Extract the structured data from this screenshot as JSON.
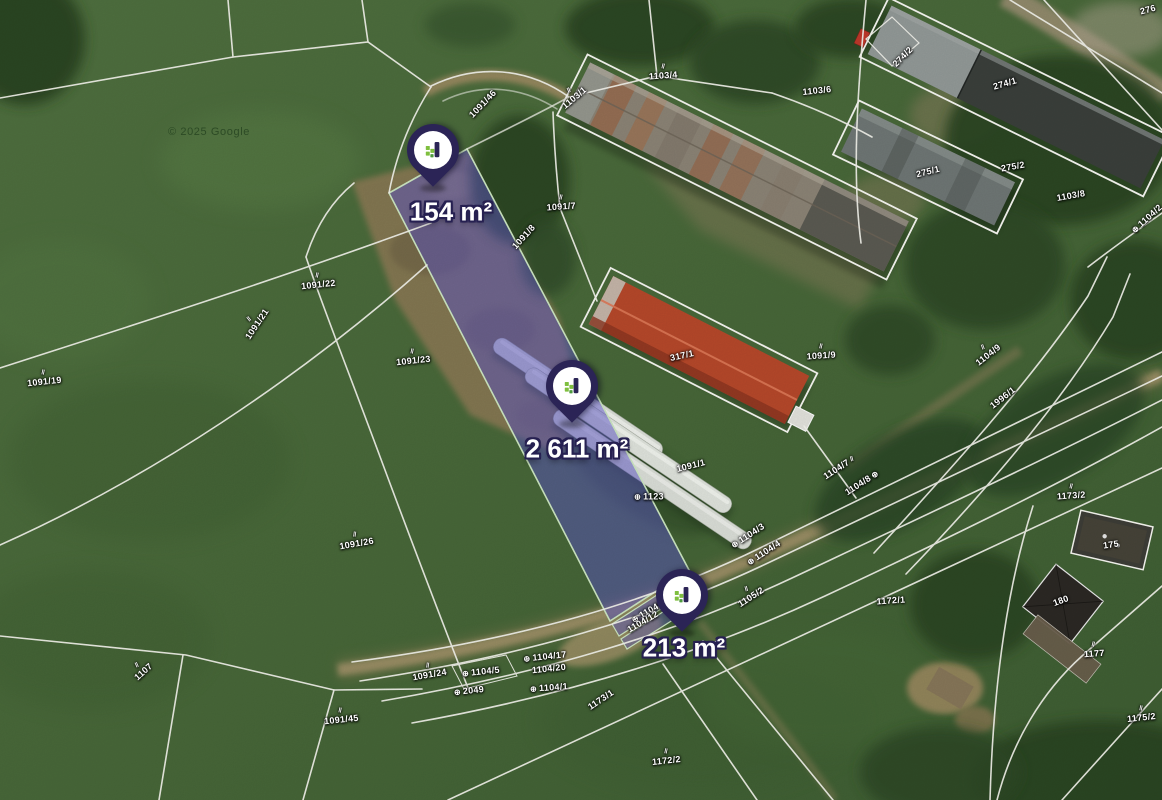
{
  "map": {
    "attribution": "© 2025 Google",
    "colors": {
      "pin": "#2b2456",
      "pin_logo_green": "#7fbf3f",
      "highlight_fill": "#5b54c9",
      "highlight_border": "#cfe9c4",
      "cadastral_line": "#f7f7f0"
    },
    "pin_markers": [
      {
        "area": "154 m²",
        "x": 433,
        "y": 150,
        "label_x": 451,
        "label_y": 212
      },
      {
        "area": "2 611 m²",
        "x": 572,
        "y": 386,
        "label_x": 577,
        "label_y": 449
      },
      {
        "area": "213 m²",
        "x": 682,
        "y": 595,
        "label_x": 684,
        "label_y": 648
      }
    ],
    "parcel_labels": [
      {
        "text": "1103/4",
        "x": 663,
        "y": 72,
        "rot": -4,
        "mark": "hatch"
      },
      {
        "text": "1103/1",
        "x": 572,
        "y": 95,
        "rot": -40,
        "mark": "hatch"
      },
      {
        "text": "1103/6",
        "x": 817,
        "y": 91,
        "rot": -6,
        "mark": null
      },
      {
        "text": "274/2",
        "x": 903,
        "y": 57,
        "rot": -45,
        "mark": null
      },
      {
        "text": "274/1",
        "x": 1005,
        "y": 84,
        "rot": -16,
        "mark": null
      },
      {
        "text": "275/1",
        "x": 928,
        "y": 172,
        "rot": -14,
        "mark": null
      },
      {
        "text": "275/2",
        "x": 1013,
        "y": 167,
        "rot": -10,
        "mark": null
      },
      {
        "text": "1103/8",
        "x": 1071,
        "y": 196,
        "rot": -10,
        "mark": null
      },
      {
        "text": "276",
        "x": 1148,
        "y": 10,
        "rot": -15,
        "mark": null
      },
      {
        "text": "1104/2",
        "x": 1147,
        "y": 219,
        "rot": -42,
        "mark": "circle"
      },
      {
        "text": "1091/46",
        "x": 483,
        "y": 104,
        "rot": -46,
        "mark": null
      },
      {
        "text": "1091/7",
        "x": 561,
        "y": 203,
        "rot": -4,
        "mark": "hatch"
      },
      {
        "text": "1091/8",
        "x": 524,
        "y": 237,
        "rot": -48,
        "mark": null
      },
      {
        "text": "317/1",
        "x": 682,
        "y": 356,
        "rot": -12,
        "mark": null
      },
      {
        "text": "1091/9",
        "x": 821,
        "y": 352,
        "rot": -4,
        "mark": "hatch"
      },
      {
        "text": "1091/19",
        "x": 44,
        "y": 378,
        "rot": -6,
        "mark": "hatch"
      },
      {
        "text": "1091/21",
        "x": 254,
        "y": 322,
        "rot": -56,
        "mark": "hatch"
      },
      {
        "text": "1091/22",
        "x": 318,
        "y": 281,
        "rot": -6,
        "mark": "hatch"
      },
      {
        "text": "1091/23",
        "x": 413,
        "y": 357,
        "rot": -6,
        "mark": "hatch"
      },
      {
        "text": "1091/26",
        "x": 356,
        "y": 540,
        "rot": -10,
        "mark": "hatch"
      },
      {
        "text": "1091/1",
        "x": 691,
        "y": 466,
        "rot": -14,
        "mark": null
      },
      {
        "text": "1123",
        "x": 649,
        "y": 497,
        "rot": 0,
        "mark": "circle"
      },
      {
        "text": "1104/9",
        "x": 986,
        "y": 352,
        "rot": -38,
        "mark": "hatch"
      },
      {
        "text": "1996/1",
        "x": 1003,
        "y": 398,
        "rot": -38,
        "mark": null
      },
      {
        "text": "1104/7",
        "x": 839,
        "y": 468,
        "rot": -33,
        "mark": "hatch-after"
      },
      {
        "text": "1104/8",
        "x": 862,
        "y": 483,
        "rot": -33,
        "mark": "circle-after"
      },
      {
        "text": "1173/2",
        "x": 1071,
        "y": 492,
        "rot": -4,
        "mark": "hatch"
      },
      {
        "text": "175",
        "x": 1111,
        "y": 545,
        "rot": -8,
        "mark": null
      },
      {
        "text": "180",
        "x": 1061,
        "y": 601,
        "rot": -20,
        "mark": null
      },
      {
        "text": "1177",
        "x": 1094,
        "y": 650,
        "rot": -4,
        "mark": "hatch"
      },
      {
        "text": "1175/2",
        "x": 1141,
        "y": 714,
        "rot": -6,
        "mark": "hatch"
      },
      {
        "text": "1172/1",
        "x": 891,
        "y": 601,
        "rot": -4,
        "mark": null
      },
      {
        "text": "1172/2",
        "x": 666,
        "y": 757,
        "rot": -6,
        "mark": "hatch"
      },
      {
        "text": "1105/2",
        "x": 749,
        "y": 594,
        "rot": -33,
        "mark": "hatch"
      },
      {
        "text": "1104/3",
        "x": 748,
        "y": 536,
        "rot": -33,
        "mark": "circle"
      },
      {
        "text": "1104/4",
        "x": 764,
        "y": 553,
        "rot": -33,
        "mark": "circle"
      },
      {
        "text": "1104/13",
        "x": 651,
        "y": 610,
        "rot": -30,
        "mark": "circle"
      },
      {
        "text": "1104/12",
        "x": 643,
        "y": 622,
        "rot": -30,
        "mark": null
      },
      {
        "text": "1104/17",
        "x": 545,
        "y": 657,
        "rot": -6,
        "mark": "circle"
      },
      {
        "text": "1104/20",
        "x": 549,
        "y": 669,
        "rot": -6,
        "mark": null
      },
      {
        "text": "1104/1",
        "x": 549,
        "y": 688,
        "rot": -4,
        "mark": "circle"
      },
      {
        "text": "1104/5",
        "x": 481,
        "y": 672,
        "rot": -6,
        "mark": "circle"
      },
      {
        "text": "2049",
        "x": 469,
        "y": 691,
        "rot": -6,
        "mark": "circle"
      },
      {
        "text": "1091/24",
        "x": 429,
        "y": 671,
        "rot": -10,
        "mark": "hatch"
      },
      {
        "text": "1107",
        "x": 141,
        "y": 669,
        "rot": -42,
        "mark": "hatch"
      },
      {
        "text": "1091/45",
        "x": 341,
        "y": 716,
        "rot": -6,
        "mark": "hatch"
      },
      {
        "text": "1173/1",
        "x": 601,
        "y": 700,
        "rot": -34,
        "mark": null
      }
    ]
  }
}
